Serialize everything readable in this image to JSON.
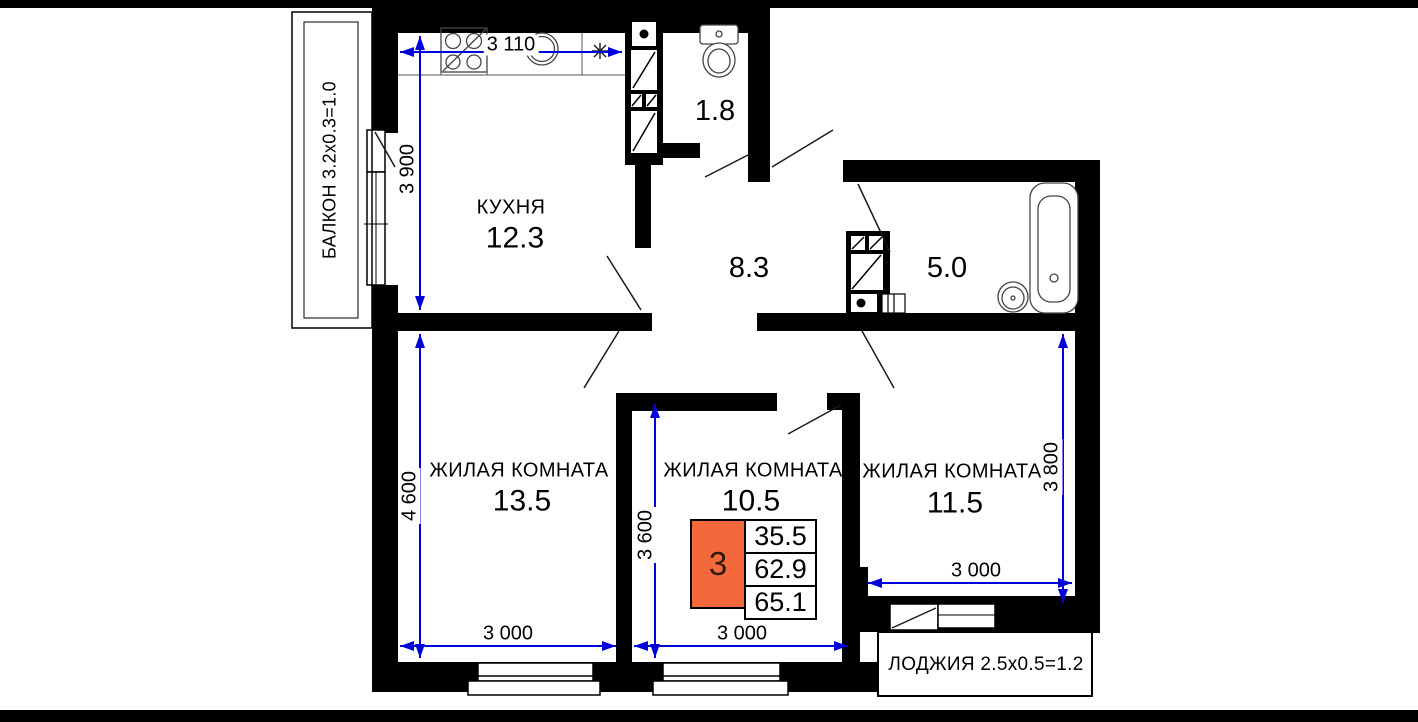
{
  "plan": {
    "balcony": {
      "label": "БАЛКОН 3.2x0.3=1.0"
    },
    "loggia": {
      "label": "ЛОДЖИЯ 2.5x0.5=1.2"
    },
    "rooms": {
      "kitchen": {
        "name": "КУХНЯ",
        "area": "12.3"
      },
      "wc": {
        "area": "1.8"
      },
      "hallway": {
        "area": "8.3"
      },
      "bathroom": {
        "area": "5.0"
      },
      "living_room_1": {
        "name": "ЖИЛАЯ КОМНАТА",
        "area": "13.5"
      },
      "living_room_2": {
        "name": "ЖИЛАЯ КОМНАТА",
        "area": "10.5"
      },
      "living_room_3": {
        "name": "ЖИЛАЯ КОМНАТА",
        "area": "11.5"
      }
    },
    "dimensions": {
      "kitchen_width": "3 110",
      "kitchen_depth": "3 900",
      "living1_depth": "4 600",
      "living1_width": "3 000",
      "living2_depth": "3 600",
      "living2_width": "3 000",
      "living3_depth": "3 800",
      "living3_width": "3 000"
    },
    "summary": {
      "number": "3",
      "living_area": "35.5",
      "area_without_balcony": "62.9",
      "total_area": "65.1"
    },
    "colors": {
      "wall": "#000000",
      "dimension_line": "#0000dd",
      "summary_highlight": "#F4693B"
    }
  }
}
